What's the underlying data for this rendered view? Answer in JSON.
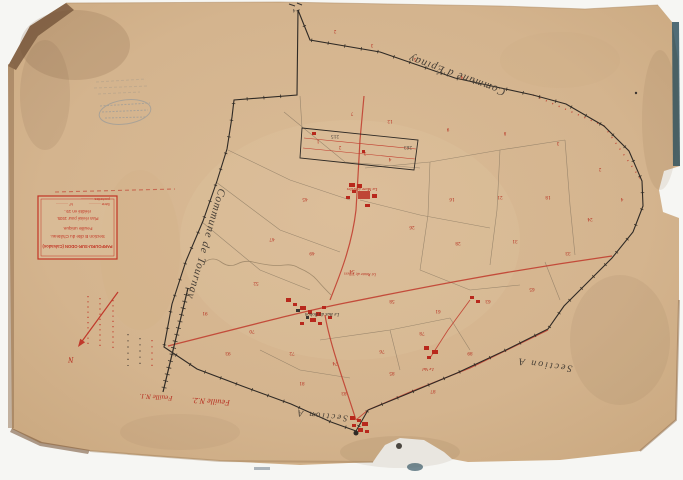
{
  "palette": {
    "scan_background": "#f6f6f3",
    "paper": "#d4b48e",
    "paper_edge_dark": "#7a5a3e",
    "ink_black": "#2f2a25",
    "ink_grey": "#8b7a63",
    "ink_red": "#c0392b",
    "stamp_blue": "#5b7fa3",
    "edge_teal": "#33545f"
  },
  "cartouche": {
    "title": "PARFOURU-SUR-ODON (Calvados)",
    "section_line": "Section B dite du Château.",
    "sheet_line": "Feuille unique.",
    "revision_line": "Plan révisé pour 1935.",
    "edition_line": "réédité en 19..",
    "fields": [
      {
        "label": "Série ............"
      },
      {
        "label": "N° ............"
      },
      {
        "label": "pochettes ............"
      }
    ]
  },
  "map_labels": {
    "commune_west": "Commune de Tournay",
    "commune_north": "Commune d'Épinay",
    "section_a_east": "Section A",
    "section_a_south": "Section A",
    "sheet_no_1": "Feuille N.1.",
    "sheet_no_2": "Feuille N.2.",
    "north_letter": "N",
    "place_chateau": "La Mare à Selles",
    "place_village": "Le Bas du Bohon",
    "place_hamlet": "Le Val",
    "road_name": "La Route de Villers"
  },
  "parcel_numbers": [
    {
      "x": 335,
      "y": 30,
      "v": "2"
    },
    {
      "x": 372,
      "y": 44,
      "v": "3"
    },
    {
      "x": 415,
      "y": 58,
      "v": "5"
    },
    {
      "x": 462,
      "y": 76,
      "v": "4"
    },
    {
      "x": 352,
      "y": 112,
      "v": "7"
    },
    {
      "x": 390,
      "y": 120,
      "v": "12"
    },
    {
      "x": 448,
      "y": 128,
      "v": "9"
    },
    {
      "x": 505,
      "y": 132,
      "v": "8"
    },
    {
      "x": 558,
      "y": 142,
      "v": "3"
    },
    {
      "x": 600,
      "y": 168,
      "v": "2"
    },
    {
      "x": 622,
      "y": 198,
      "v": "4"
    },
    {
      "x": 590,
      "y": 218,
      "v": "24"
    },
    {
      "x": 548,
      "y": 196,
      "v": "18"
    },
    {
      "x": 500,
      "y": 196,
      "v": "21"
    },
    {
      "x": 452,
      "y": 198,
      "v": "16"
    },
    {
      "x": 412,
      "y": 226,
      "v": "26"
    },
    {
      "x": 458,
      "y": 242,
      "v": "28"
    },
    {
      "x": 515,
      "y": 240,
      "v": "31"
    },
    {
      "x": 568,
      "y": 252,
      "v": "33"
    },
    {
      "x": 305,
      "y": 198,
      "v": "45"
    },
    {
      "x": 272,
      "y": 238,
      "v": "47"
    },
    {
      "x": 256,
      "y": 282,
      "v": "52"
    },
    {
      "x": 312,
      "y": 252,
      "v": "49"
    },
    {
      "x": 352,
      "y": 270,
      "v": "54"
    },
    {
      "x": 392,
      "y": 300,
      "v": "58"
    },
    {
      "x": 438,
      "y": 310,
      "v": "61"
    },
    {
      "x": 488,
      "y": 300,
      "v": "63"
    },
    {
      "x": 532,
      "y": 288,
      "v": "65"
    },
    {
      "x": 252,
      "y": 330,
      "v": "70"
    },
    {
      "x": 292,
      "y": 352,
      "v": "72"
    },
    {
      "x": 335,
      "y": 362,
      "v": "74"
    },
    {
      "x": 382,
      "y": 350,
      "v": "76"
    },
    {
      "x": 422,
      "y": 332,
      "v": "78"
    },
    {
      "x": 302,
      "y": 382,
      "v": "81"
    },
    {
      "x": 344,
      "y": 392,
      "v": "83"
    },
    {
      "x": 392,
      "y": 372,
      "v": "85"
    },
    {
      "x": 433,
      "y": 390,
      "v": "87"
    },
    {
      "x": 470,
      "y": 352,
      "v": "89"
    },
    {
      "x": 205,
      "y": 312,
      "v": "91"
    },
    {
      "x": 228,
      "y": 352,
      "v": "93"
    },
    {
      "x": 318,
      "y": 140,
      "v": "1"
    },
    {
      "x": 340,
      "y": 146,
      "v": "2"
    },
    {
      "x": 365,
      "y": 152,
      "v": "3"
    },
    {
      "x": 390,
      "y": 158,
      "v": "4"
    },
    {
      "x": 335,
      "y": 135,
      "v": "215",
      "c": "k"
    },
    {
      "x": 408,
      "y": 146,
      "v": "263",
      "c": "k"
    },
    {
      "x": 294,
      "y": 9,
      "v": "4",
      "c": "k"
    }
  ]
}
